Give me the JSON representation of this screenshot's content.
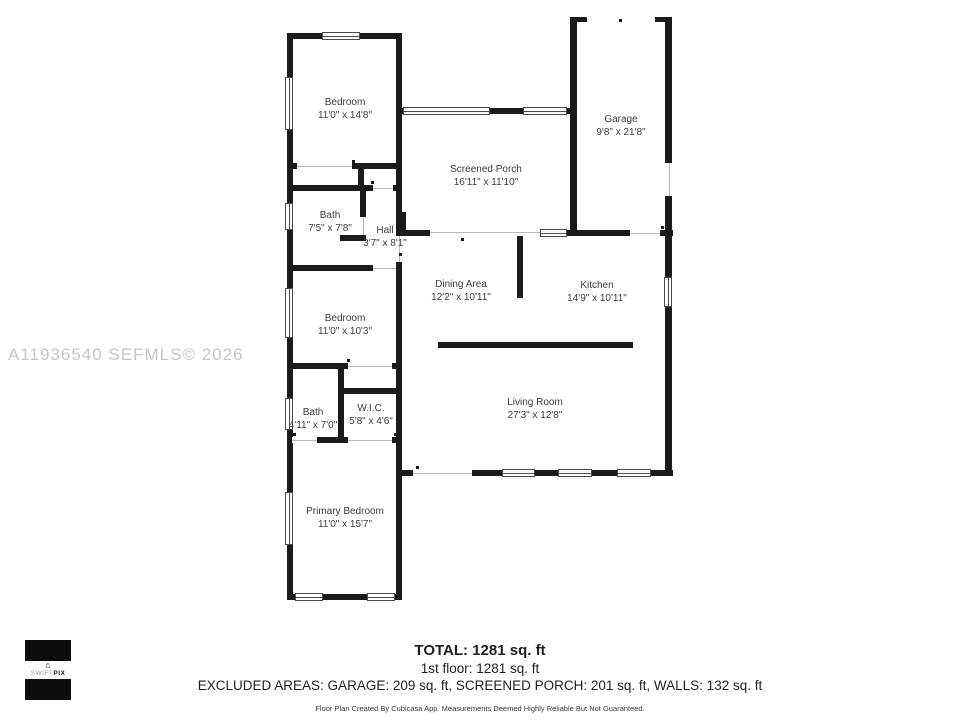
{
  "watermark": "A11936540  SEFMLS© 2026",
  "rooms": [
    {
      "name": "Bedroom",
      "dims": "11'0\" x 14'8\""
    },
    {
      "name": "Screened Porch",
      "dims": "16'11\" x 11'10\""
    },
    {
      "name": "Garage",
      "dims": "9'8\" x 21'8\""
    },
    {
      "name": "Bath",
      "dims": "7'5\" x 7'8\""
    },
    {
      "name": "Hall",
      "dims": "3'7\" x 8'1\""
    },
    {
      "name": "Dining Area",
      "dims": "12'2\" x 10'11\""
    },
    {
      "name": "Kitchen",
      "dims": "14'9\" x 10'11\""
    },
    {
      "name": "Bedroom",
      "dims": "11'0\" x 10'3\""
    },
    {
      "name": "Bath",
      "dims": "4'11\" x 7'0\""
    },
    {
      "name": "W.I.C.",
      "dims": "5'8\" x 4'6\""
    },
    {
      "name": "Living Room",
      "dims": "27'3\" x 12'8\""
    },
    {
      "name": "Primary Bedroom",
      "dims": "11'0\" x 15'7\""
    }
  ],
  "footer": {
    "total": "TOTAL: 1281 sq. ft",
    "floor": "1st floor: 1281 sq. ft",
    "excluded": "EXCLUDED AREAS: GARAGE: 209 sq. ft, SCREENED PORCH: 201 sq. ft, WALLS: 132 sq. ft",
    "disclaimer": "Floor Plan Created By Cubicasa App. Measurements Deemed Highly Reliable But Not Guaranteed."
  },
  "logo": {
    "house_icon": "⌂",
    "brand_light": "SWIFT",
    "brand_bold": "PIX"
  },
  "colors": {
    "wall": "#1b1b1b",
    "label_text": "#3c3c3c",
    "watermark_text": "#c6c6c6"
  }
}
